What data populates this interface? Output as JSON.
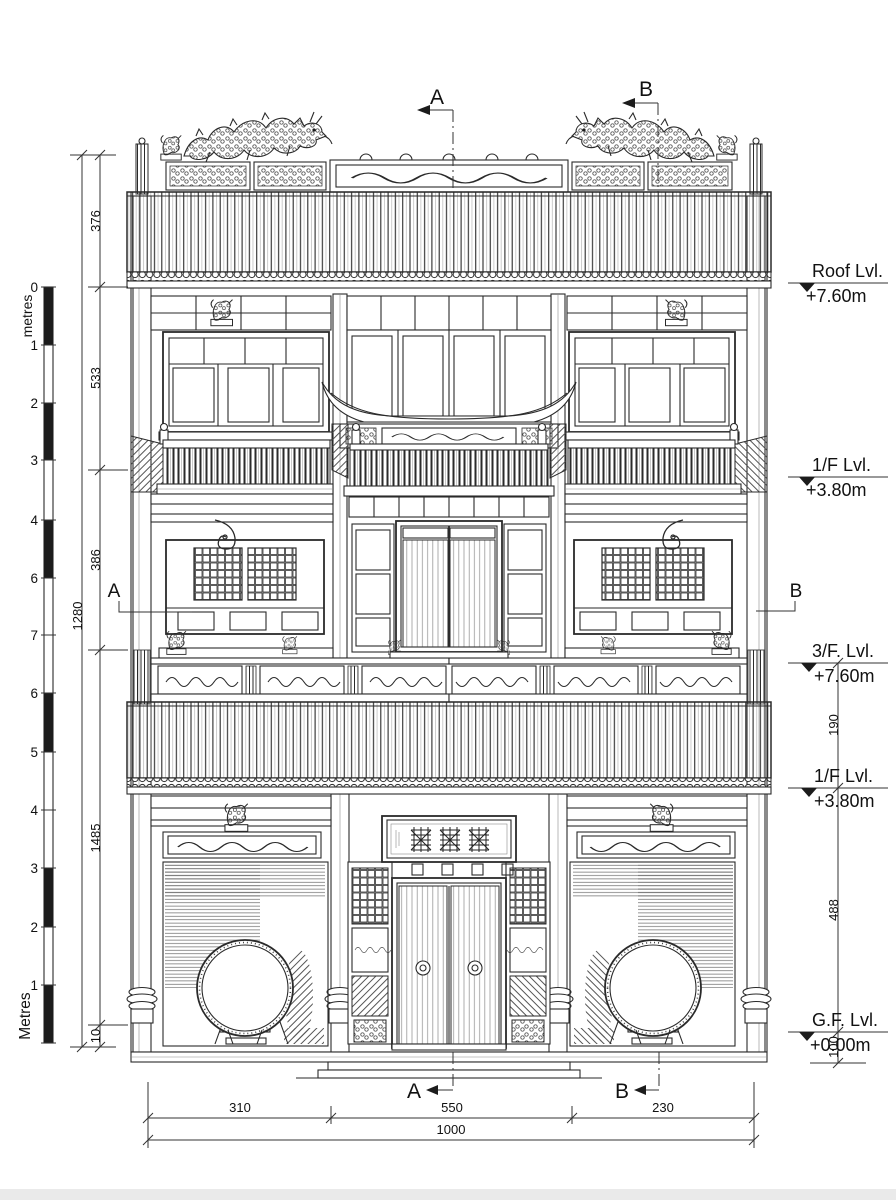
{
  "colors": {
    "ink": "#222222",
    "paper": "#ffffff",
    "shade": "#999999"
  },
  "scale_bar": {
    "top_unit_label": "metres",
    "bottom_unit_label": "Metres",
    "tick_labels": [
      "0",
      "1",
      "2",
      "3",
      "4",
      "6",
      "7",
      "6",
      "5",
      "4",
      "3",
      "2",
      "1"
    ]
  },
  "dimensions": {
    "left_total": "1280",
    "left_segments": [
      "376",
      "533",
      "386",
      "1485",
      "10"
    ],
    "right_segments": [
      "190",
      "488",
      "100"
    ],
    "bottom_segments": [
      "310",
      "550",
      "230"
    ],
    "bottom_total": "1000"
  },
  "levels": [
    {
      "name": "Roof Lvl.",
      "elevation": "+7.60m"
    },
    {
      "name": "1/F Lvl.",
      "elevation": "+3.80m"
    },
    {
      "name": "3/F. Lvl.",
      "elevation": "+7.60m"
    },
    {
      "name": "1/F Lvl.",
      "elevation": "+3.80m"
    },
    {
      "name": "G.F. Lvl.",
      "elevation": "+0.00m"
    }
  ],
  "section_markers": {
    "a": "A",
    "b": "B"
  }
}
